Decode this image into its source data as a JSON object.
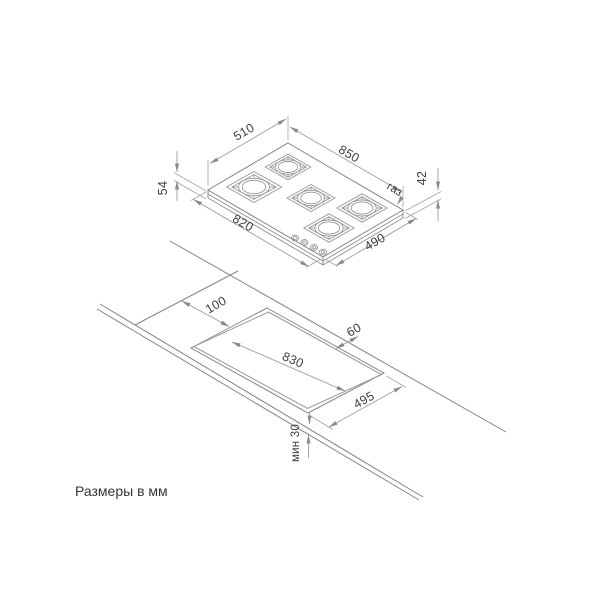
{
  "top_view": {
    "dim_depth_rear": "510",
    "dim_width_rear": "850",
    "dim_height_left": "54",
    "dim_height_right": "42",
    "dim_width_front": "820",
    "dim_depth_front": "490",
    "gas_label": "газ"
  },
  "cutout_view": {
    "dim_left_offset": "100",
    "dim_rear_offset": "60",
    "dim_cutout_width": "830",
    "dim_cutout_depth": "495",
    "dim_front_min": "мин 30"
  },
  "footer": {
    "units_note": "Размеры в мм"
  },
  "colors": {
    "background": "#ffffff",
    "drawing_line": "#868686",
    "dimension_line": "#9d9d9d",
    "text": "#3f3f3f"
  }
}
